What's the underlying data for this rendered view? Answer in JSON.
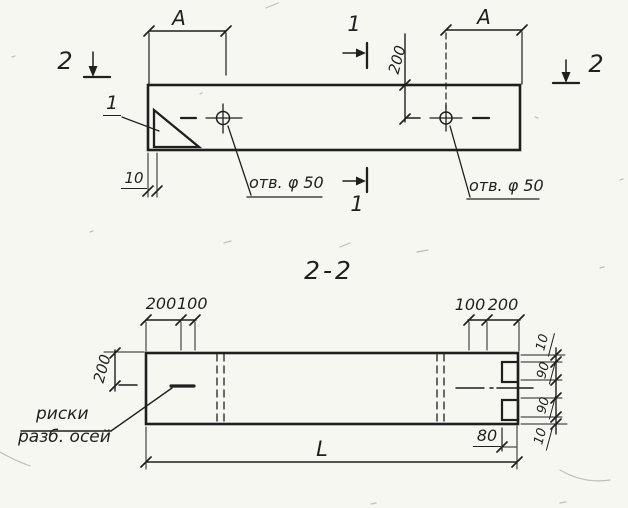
{
  "plan": {
    "section2_left": "2",
    "section2_right": "2",
    "section1_top": "1",
    "section1_bottom": "1",
    "detail_ref": "1",
    "dimA_left": "A",
    "dimA_right": "A",
    "dim200": "200",
    "dim10": "10",
    "hole_label_left": "отв. φ 50",
    "hole_label_right": "отв. φ 50"
  },
  "section": {
    "title": "2-2",
    "top_left_dims": [
      "200",
      "100"
    ],
    "top_right_dims": [
      "100",
      "200"
    ],
    "left_dim": "200",
    "right_dims": [
      "10",
      "90",
      "90",
      "10"
    ],
    "dim80": "80",
    "length_label": "L",
    "note_line1": "риски",
    "note_line2": "разб. осей"
  },
  "ink_color": "#1f1f1f"
}
